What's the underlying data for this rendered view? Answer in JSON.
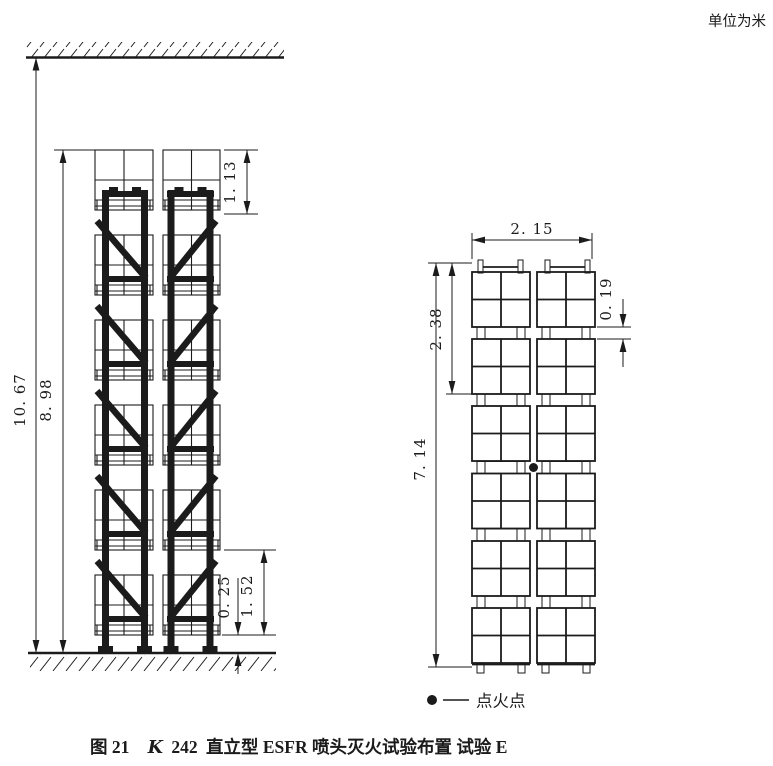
{
  "page": {
    "unit_note": "单位为米",
    "ink_color": "#1b1b1b",
    "background_color": "#ffffff"
  },
  "caption": {
    "figure_label": "图 21",
    "k_factor_italic": "K",
    "k_factor_number": "242",
    "title_text": "直立型 ESFR 喷头灭火试验布置 试验 E"
  },
  "legend": {
    "symbol": "ignition-point-dot",
    "label": "点火点"
  },
  "front_view": {
    "description": "front elevation, two-bay rack with six tiers of boxed loads between ceiling and floor",
    "dimensions": {
      "ceiling_to_floor": "10. 67",
      "top_of_load_to_floor": "8. 98",
      "top_load_height": "1. 13",
      "bottom_load_height": "1. 52",
      "floor_clearance": "0. 25"
    }
  },
  "side_view": {
    "description": "side view, two columns of six palletized loads",
    "dimensions": {
      "overall_width": "2. 15",
      "two_tier_height": "2. 38",
      "stack_height": "7. 14",
      "pallet_height": "0. 19"
    }
  }
}
